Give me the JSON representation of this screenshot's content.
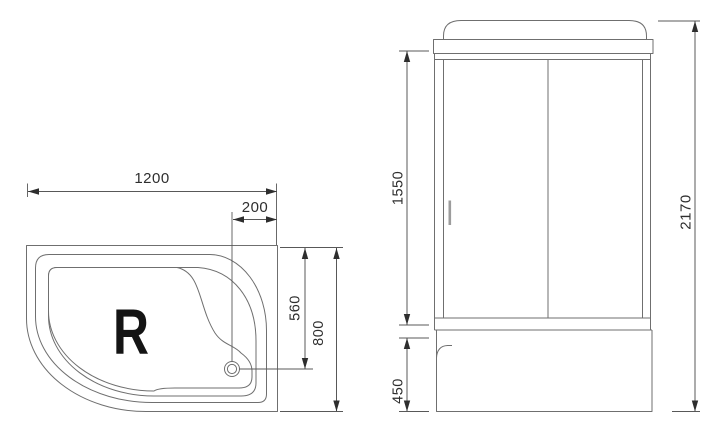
{
  "tray_top_view": {
    "orientation_label": "R",
    "dim_width_mm": "1200",
    "dim_drain_to_edge_mm": "200",
    "dim_drain_axis_mm": "560",
    "dim_depth_mm": "800"
  },
  "cabin_front_view": {
    "dim_door_height_mm": "1550",
    "dim_base_height_mm": "450",
    "dim_total_height_mm": "2170"
  },
  "colors": {
    "background": "#ffffff",
    "line": "#6f6f6f",
    "dim_line": "#585858",
    "dim_text": "#2e2e2e",
    "orientation_label": "#141414",
    "handle": "#9c9c9c"
  }
}
